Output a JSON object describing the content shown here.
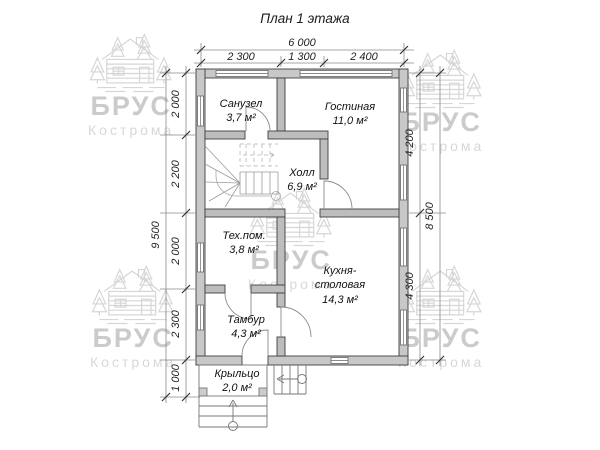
{
  "title": "План 1 этажа",
  "watermark": {
    "brand": "БРУС",
    "city": "Кострома"
  },
  "rooms": [
    {
      "name": "Санузел",
      "area": "3,7 м²"
    },
    {
      "name": "Гостиная",
      "area": "11,0 м²"
    },
    {
      "name": "Холл",
      "area": "6,9 м²"
    },
    {
      "name": "Тех.пом.",
      "area": "3,8 м²"
    },
    {
      "name": "Кухня-",
      "name2": "столовая",
      "area": "14,3 м²"
    },
    {
      "name": "Тамбур",
      "area": "4,3 м²"
    },
    {
      "name": "Крыльцо",
      "area": "2,0 м²"
    }
  ],
  "dimensions": {
    "top_total": "6 000",
    "top_segments": [
      "2 300",
      "1 300",
      "2 400"
    ],
    "left_total": "9 500",
    "left_segments": [
      "2 000",
      "2 200",
      "2 000",
      "2 300",
      "1 000"
    ],
    "right_total": "8 500",
    "right_segments": [
      "4 200",
      "4 300"
    ]
  },
  "colors": {
    "background": "#ffffff",
    "wall_fill": "#c8c8c8",
    "interior_wall_fill": "#bdbdbd",
    "wall_stroke": "#3f3f3f",
    "dimension_color": "#555555",
    "tick_color": "#333333",
    "text_color": "#1a1a1a",
    "watermark_color": "#d4d4d4"
  }
}
